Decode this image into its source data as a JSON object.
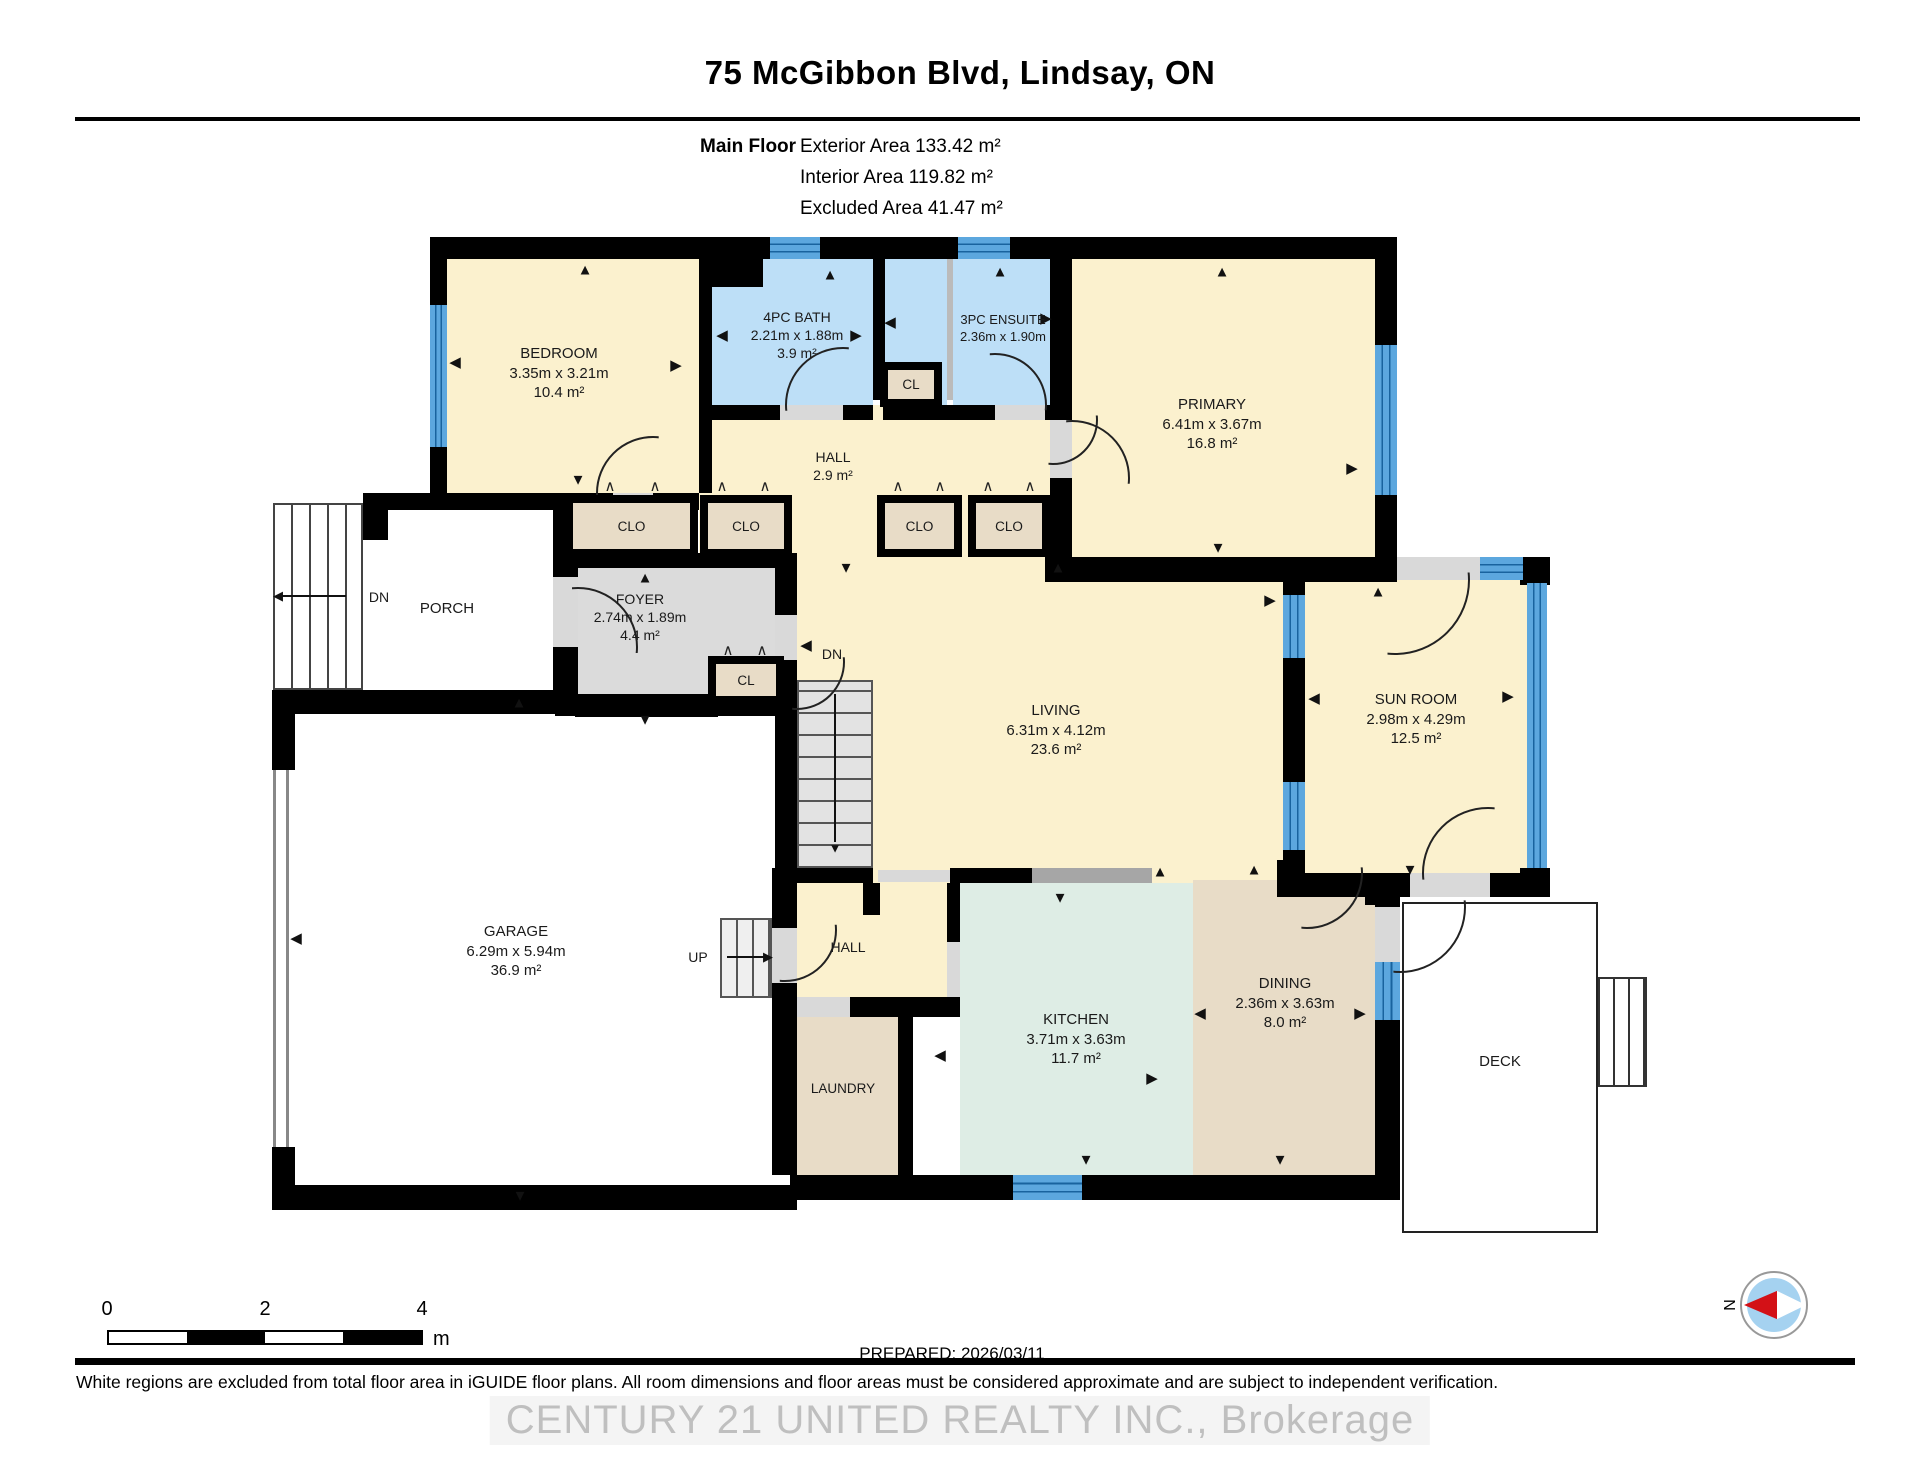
{
  "header": {
    "title": "75 McGibbon Blvd, Lindsay, ON",
    "floor_label": "Main Floor",
    "areas": [
      {
        "label": "Exterior Area",
        "value": "133.42 m²"
      },
      {
        "label": "Interior Area",
        "value": "119.82 m²"
      },
      {
        "label": "Excluded Area",
        "value": "41.47 m²"
      }
    ]
  },
  "footer": {
    "prepared": "PREPARED: 2026/03/11",
    "disclaimer": "White regions are excluded from total floor area in iGUIDE floor plans. All room dimensions and floor areas must be considered approximate and are subject to independent verification.",
    "watermark": "CENTURY 21 UNITED REALTY INC., Brokerage",
    "compass_letter": "N",
    "scale": {
      "ticks": [
        "0",
        "2",
        "4"
      ],
      "unit": "m"
    }
  },
  "colors": {
    "cream": "#FBF1CE",
    "blue": "#BDDFF7",
    "tan": "#E8DCC7",
    "mint": "#DEEDE5",
    "gray": "#DBDBDB",
    "wall": "#000000",
    "window": "#5CA7DE",
    "counter": "#A6A6A6",
    "stair": "#E3E3E3",
    "accent_red": "#D31117",
    "compass_blue": "#A5D2F0"
  },
  "plan": {
    "rooms": [
      {
        "name": "bedroom",
        "x": 447,
        "y": 259,
        "w": 252,
        "h": 234,
        "c": "cream"
      },
      {
        "name": "bath-4pc",
        "x": 712,
        "y": 259,
        "w": 161,
        "h": 146,
        "c": "blue"
      },
      {
        "name": "ensuite-nook",
        "x": 885,
        "y": 259,
        "w": 62,
        "h": 146,
        "c": "blue"
      },
      {
        "name": "ensuite-3pc",
        "x": 953,
        "y": 259,
        "w": 100,
        "h": 146,
        "c": "blue"
      },
      {
        "name": "primary",
        "x": 1072,
        "y": 259,
        "w": 303,
        "h": 298,
        "c": "cream"
      },
      {
        "name": "hall-upper",
        "x": 699,
        "y": 405,
        "w": 373,
        "h": 152,
        "c": "cream"
      },
      {
        "name": "living",
        "x": 797,
        "y": 557,
        "w": 486,
        "h": 326,
        "c": "cream"
      },
      {
        "name": "sun-room",
        "x": 1305,
        "y": 580,
        "w": 222,
        "h": 293,
        "c": "cream"
      },
      {
        "name": "hall-lower",
        "x": 785,
        "y": 883,
        "w": 162,
        "h": 114,
        "c": "cream"
      },
      {
        "name": "foyer",
        "x": 575,
        "y": 567,
        "w": 210,
        "h": 131,
        "c": "gray"
      },
      {
        "name": "laundry",
        "x": 787,
        "y": 1017,
        "w": 111,
        "h": 158,
        "c": "tan"
      },
      {
        "name": "kitchen",
        "x": 960,
        "y": 883,
        "w": 233,
        "h": 292,
        "c": "mint"
      },
      {
        "name": "dining",
        "x": 1193,
        "y": 880,
        "w": 182,
        "h": 295,
        "c": "tan"
      }
    ],
    "walls": [
      [
        430,
        237,
        967,
        22
      ],
      [
        430,
        259,
        17,
        46
      ],
      [
        430,
        447,
        17,
        63
      ],
      [
        363,
        493,
        250,
        17
      ],
      [
        653,
        493,
        46,
        17
      ],
      [
        699,
        259,
        13,
        234
      ],
      [
        712,
        259,
        51,
        28
      ],
      [
        873,
        259,
        12,
        141
      ],
      [
        699,
        405,
        81,
        15
      ],
      [
        843,
        405,
        30,
        15
      ],
      [
        883,
        405,
        112,
        15
      ],
      [
        1045,
        405,
        27,
        15
      ],
      [
        1050,
        259,
        22,
        161
      ],
      [
        1050,
        478,
        22,
        104
      ],
      [
        1045,
        557,
        352,
        25
      ],
      [
        1375,
        237,
        22,
        108
      ],
      [
        1375,
        495,
        22,
        62
      ],
      [
        1281,
        557,
        114,
        23
      ],
      [
        1520,
        557,
        30,
        28
      ],
      [
        1283,
        580,
        22,
        15
      ],
      [
        1283,
        658,
        22,
        124
      ],
      [
        1283,
        850,
        22,
        47
      ],
      [
        1520,
        868,
        30,
        29
      ],
      [
        1281,
        873,
        129,
        24
      ],
      [
        1490,
        873,
        60,
        24
      ],
      [
        555,
        553,
        230,
        15
      ],
      [
        553,
        510,
        25,
        67
      ],
      [
        553,
        647,
        25,
        55
      ],
      [
        575,
        698,
        143,
        19
      ],
      [
        272,
        690,
        303,
        24
      ],
      [
        555,
        694,
        242,
        22
      ],
      [
        272,
        714,
        23,
        56
      ],
      [
        272,
        1147,
        23,
        63
      ],
      [
        272,
        1185,
        525,
        25
      ],
      [
        775,
        553,
        22,
        62
      ],
      [
        775,
        660,
        22,
        208
      ],
      [
        772,
        868,
        25,
        60
      ],
      [
        772,
        983,
        25,
        192
      ],
      [
        797,
        868,
        76,
        15
      ],
      [
        863,
        883,
        17,
        32
      ],
      [
        950,
        868,
        82,
        15
      ],
      [
        947,
        883,
        13,
        59
      ],
      [
        850,
        997,
        110,
        20
      ],
      [
        898,
        1017,
        15,
        158
      ],
      [
        790,
        1175,
        226,
        25
      ],
      [
        1082,
        1175,
        318,
        25
      ],
      [
        1277,
        860,
        26,
        37
      ],
      [
        1365,
        875,
        35,
        30
      ],
      [
        1375,
        880,
        25,
        27
      ],
      [
        1375,
        1020,
        25,
        155
      ],
      [
        362,
        503,
        26,
        37
      ]
    ],
    "sills": [
      [
        613,
        493,
        40,
        17
      ],
      [
        780,
        405,
        63,
        15
      ],
      [
        995,
        405,
        50,
        15
      ],
      [
        1050,
        420,
        22,
        58
      ],
      [
        553,
        577,
        25,
        70
      ],
      [
        775,
        615,
        22,
        45
      ],
      [
        1395,
        557,
        85,
        23
      ],
      [
        1410,
        873,
        80,
        24
      ],
      [
        1375,
        907,
        25,
        55
      ],
      [
        772,
        928,
        25,
        55
      ],
      [
        947,
        942,
        13,
        56
      ],
      [
        878,
        870,
        72,
        12
      ],
      [
        793,
        997,
        57,
        20
      ]
    ],
    "divider_gray": [
      947,
      259,
      6,
      141
    ],
    "counter": [
      1030,
      868,
      122,
      15
    ],
    "windows": [
      {
        "x": 430,
        "y": 305,
        "w": 17,
        "h": 142,
        "o": "v"
      },
      {
        "x": 770,
        "y": 237,
        "w": 50,
        "h": 22,
        "o": "h"
      },
      {
        "x": 958,
        "y": 237,
        "w": 52,
        "h": 22,
        "o": "h"
      },
      {
        "x": 1375,
        "y": 345,
        "w": 22,
        "h": 150,
        "o": "v"
      },
      {
        "x": 1480,
        "y": 557,
        "w": 43,
        "h": 23,
        "o": "h"
      },
      {
        "x": 1283,
        "y": 595,
        "w": 22,
        "h": 63,
        "o": "v"
      },
      {
        "x": 1283,
        "y": 782,
        "w": 22,
        "h": 68,
        "o": "v"
      },
      {
        "x": 1527,
        "y": 583,
        "w": 20,
        "h": 285,
        "o": "v"
      },
      {
        "x": 1375,
        "y": 962,
        "w": 25,
        "h": 58,
        "o": "v"
      },
      {
        "x": 1013,
        "y": 1175,
        "w": 69,
        "h": 25,
        "o": "h"
      }
    ],
    "closets": [
      {
        "x": 565,
        "y": 495,
        "w": 133,
        "h": 62,
        "label": "CLO"
      },
      {
        "x": 700,
        "y": 495,
        "w": 92,
        "h": 62,
        "label": "CLO"
      },
      {
        "x": 877,
        "y": 495,
        "w": 85,
        "h": 62,
        "label": "CLO"
      },
      {
        "x": 968,
        "y": 495,
        "w": 82,
        "h": 62,
        "label": "CLO"
      },
      {
        "x": 880,
        "y": 362,
        "w": 62,
        "h": 45,
        "label": "CL"
      },
      {
        "x": 708,
        "y": 656,
        "w": 76,
        "h": 48,
        "label": "CL"
      }
    ],
    "labels": [
      {
        "x": 559,
        "y": 344,
        "fs": 15,
        "lines": [
          "BEDROOM",
          "3.35m x 3.21m",
          "10.4 m²"
        ]
      },
      {
        "x": 797,
        "y": 308,
        "fs": 14,
        "lines": [
          "4PC BATH",
          "2.21m x 1.88m",
          "3.9 m²"
        ]
      },
      {
        "x": 1003,
        "y": 312,
        "fs": 13,
        "lines": [
          "3PC ENSUITE",
          "2.36m x 1.90m"
        ]
      },
      {
        "x": 1212,
        "y": 395,
        "fs": 15,
        "lines": [
          "PRIMARY",
          "6.41m x 3.67m",
          "16.8 m²"
        ]
      },
      {
        "x": 833,
        "y": 448,
        "fs": 14,
        "lines": [
          "HALL",
          "2.9 m²"
        ]
      },
      {
        "x": 640,
        "y": 590,
        "fs": 14,
        "lines": [
          "FOYER",
          "2.74m x 1.89m",
          "4.4 m²"
        ]
      },
      {
        "x": 379,
        "y": 588,
        "fs": 14,
        "lines": [
          "DN"
        ]
      },
      {
        "x": 447,
        "y": 599,
        "fs": 15,
        "lines": [
          "PORCH"
        ]
      },
      {
        "x": 832,
        "y": 645,
        "fs": 14,
        "lines": [
          "DN"
        ]
      },
      {
        "x": 1056,
        "y": 701,
        "fs": 15,
        "lines": [
          "LIVING",
          "6.31m x 4.12m",
          "23.6 m²"
        ]
      },
      {
        "x": 1416,
        "y": 690,
        "fs": 15,
        "lines": [
          "SUN ROOM",
          "2.98m x 4.29m",
          "12.5 m²"
        ]
      },
      {
        "x": 516,
        "y": 922,
        "fs": 15,
        "lines": [
          "GARAGE",
          "6.29m x 5.94m",
          "36.9 m²"
        ]
      },
      {
        "x": 698,
        "y": 948,
        "fs": 14,
        "lines": [
          "UP"
        ]
      },
      {
        "x": 848,
        "y": 938,
        "fs": 14,
        "lines": [
          "HALL"
        ]
      },
      {
        "x": 843,
        "y": 1080,
        "fs": 13.5,
        "lines": [
          "LAUNDRY"
        ]
      },
      {
        "x": 1076,
        "y": 1010,
        "fs": 15,
        "lines": [
          "KITCHEN",
          "3.71m x 3.63m",
          "11.7 m²"
        ]
      },
      {
        "x": 1285,
        "y": 974,
        "fs": 15,
        "lines": [
          "DINING",
          "2.36m x 3.63m",
          "8.0 m²"
        ]
      },
      {
        "x": 1500,
        "y": 1052,
        "fs": 15,
        "lines": [
          "DECK"
        ]
      }
    ],
    "arrows": [
      {
        "x": 585,
        "y": 270,
        "g": "u"
      },
      {
        "x": 455,
        "y": 362,
        "g": "l"
      },
      {
        "x": 676,
        "y": 365,
        "g": "r"
      },
      {
        "x": 578,
        "y": 480,
        "g": "d"
      },
      {
        "x": 830,
        "y": 275,
        "g": "u"
      },
      {
        "x": 722,
        "y": 335,
        "g": "l"
      },
      {
        "x": 856,
        "y": 335,
        "g": "r"
      },
      {
        "x": 890,
        "y": 322,
        "g": "l"
      },
      {
        "x": 1046,
        "y": 318,
        "g": "r"
      },
      {
        "x": 1000,
        "y": 272,
        "g": "u"
      },
      {
        "x": 1222,
        "y": 272,
        "g": "u"
      },
      {
        "x": 1218,
        "y": 548,
        "g": "d"
      },
      {
        "x": 1352,
        "y": 468,
        "g": "r"
      },
      {
        "x": 1058,
        "y": 568,
        "g": "u"
      },
      {
        "x": 806,
        "y": 645,
        "g": "l"
      },
      {
        "x": 1270,
        "y": 600,
        "g": "r"
      },
      {
        "x": 645,
        "y": 578,
        "g": "u"
      },
      {
        "x": 645,
        "y": 720,
        "g": "d"
      },
      {
        "x": 846,
        "y": 568,
        "g": "d"
      },
      {
        "x": 519,
        "y": 703,
        "g": "u"
      },
      {
        "x": 296,
        "y": 938,
        "g": "l"
      },
      {
        "x": 520,
        "y": 1196,
        "g": "d"
      },
      {
        "x": 1060,
        "y": 898,
        "g": "d"
      },
      {
        "x": 1160,
        "y": 872,
        "g": "u"
      },
      {
        "x": 1254,
        "y": 870,
        "g": "u"
      },
      {
        "x": 1410,
        "y": 870,
        "g": "d"
      },
      {
        "x": 1314,
        "y": 698,
        "g": "l"
      },
      {
        "x": 1508,
        "y": 696,
        "g": "r"
      },
      {
        "x": 1378,
        "y": 592,
        "g": "u"
      },
      {
        "x": 940,
        "y": 1055,
        "g": "l"
      },
      {
        "x": 1152,
        "y": 1078,
        "g": "r"
      },
      {
        "x": 1086,
        "y": 1160,
        "g": "d"
      },
      {
        "x": 1200,
        "y": 1013,
        "g": "l"
      },
      {
        "x": 1360,
        "y": 1013,
        "g": "r"
      },
      {
        "x": 1280,
        "y": 1160,
        "g": "d"
      }
    ],
    "bifolds": [
      {
        "x": 610,
        "y": 486
      },
      {
        "x": 655,
        "y": 486
      },
      {
        "x": 722,
        "y": 486
      },
      {
        "x": 765,
        "y": 486
      },
      {
        "x": 898,
        "y": 486
      },
      {
        "x": 940,
        "y": 486
      },
      {
        "x": 988,
        "y": 486
      },
      {
        "x": 1030,
        "y": 486
      },
      {
        "x": 728,
        "y": 650
      },
      {
        "x": 762,
        "y": 650
      }
    ],
    "doors": [
      {
        "cx": 653,
        "cy": 493,
        "r": 57,
        "q": "tl"
      },
      {
        "cx": 843,
        "cy": 405,
        "r": 58,
        "q": "tl"
      },
      {
        "cx": 995,
        "cy": 405,
        "r": 52,
        "q": "tr"
      },
      {
        "cx": 1072,
        "cy": 478,
        "r": 58,
        "q": "tr"
      },
      {
        "cx": 578,
        "cy": 647,
        "r": 60,
        "q": "tr"
      },
      {
        "cx": 797,
        "cy": 662,
        "r": 48,
        "q": "br"
      },
      {
        "cx": 1053,
        "cy": 420,
        "r": 45,
        "q": "br"
      },
      {
        "cx": 1395,
        "cy": 580,
        "r": 75,
        "q": "br"
      },
      {
        "cx": 1488,
        "cy": 873,
        "r": 66,
        "q": "tl"
      },
      {
        "cx": 1400,
        "cy": 907,
        "r": 66,
        "q": "br"
      },
      {
        "cx": 785,
        "cy": 930,
        "r": 52,
        "q": "br"
      },
      {
        "cx": 1307,
        "cy": 873,
        "r": 56,
        "q": "br"
      }
    ],
    "stairs": [
      {
        "name": "porch-steps",
        "x": 273,
        "y": 503,
        "w": 90,
        "h": 187,
        "dir": "v",
        "gap": 16,
        "bg": "#FFFFFF",
        "bc": "#444"
      },
      {
        "name": "basement-stairs",
        "x": 797,
        "y": 680,
        "w": 76,
        "h": 188,
        "dir": "h",
        "gap": 20,
        "bg": "#E3E3E3",
        "bc": "#555"
      },
      {
        "name": "garage-steps",
        "x": 720,
        "y": 918,
        "w": 52,
        "h": 80,
        "dir": "v",
        "gap": 14,
        "bg": "#EFEFEF",
        "bc": "#555"
      },
      {
        "name": "deck-steps",
        "x": 1598,
        "y": 977,
        "w": 49,
        "h": 110,
        "dir": "v",
        "gap": 13,
        "bg": "#FFFFFF",
        "bc": "#333"
      }
    ],
    "stair_arrows": [
      {
        "line": [
          282,
          595,
          64,
          2
        ],
        "head": {
          "x": 278,
          "y": 596,
          "g": "l"
        }
      },
      {
        "line": [
          834,
          694,
          2,
          148
        ],
        "head": {
          "x": 835,
          "y": 848,
          "g": "d"
        }
      },
      {
        "line": [
          727,
          956,
          38,
          2
        ],
        "head": {
          "x": 768,
          "y": 957,
          "g": "r"
        }
      }
    ],
    "garage_door": {
      "x": 273,
      "y": 770,
      "w": 16,
      "h": 377
    },
    "deck": {
      "x": 1402,
      "y": 902,
      "w": 196,
      "h": 331
    }
  }
}
